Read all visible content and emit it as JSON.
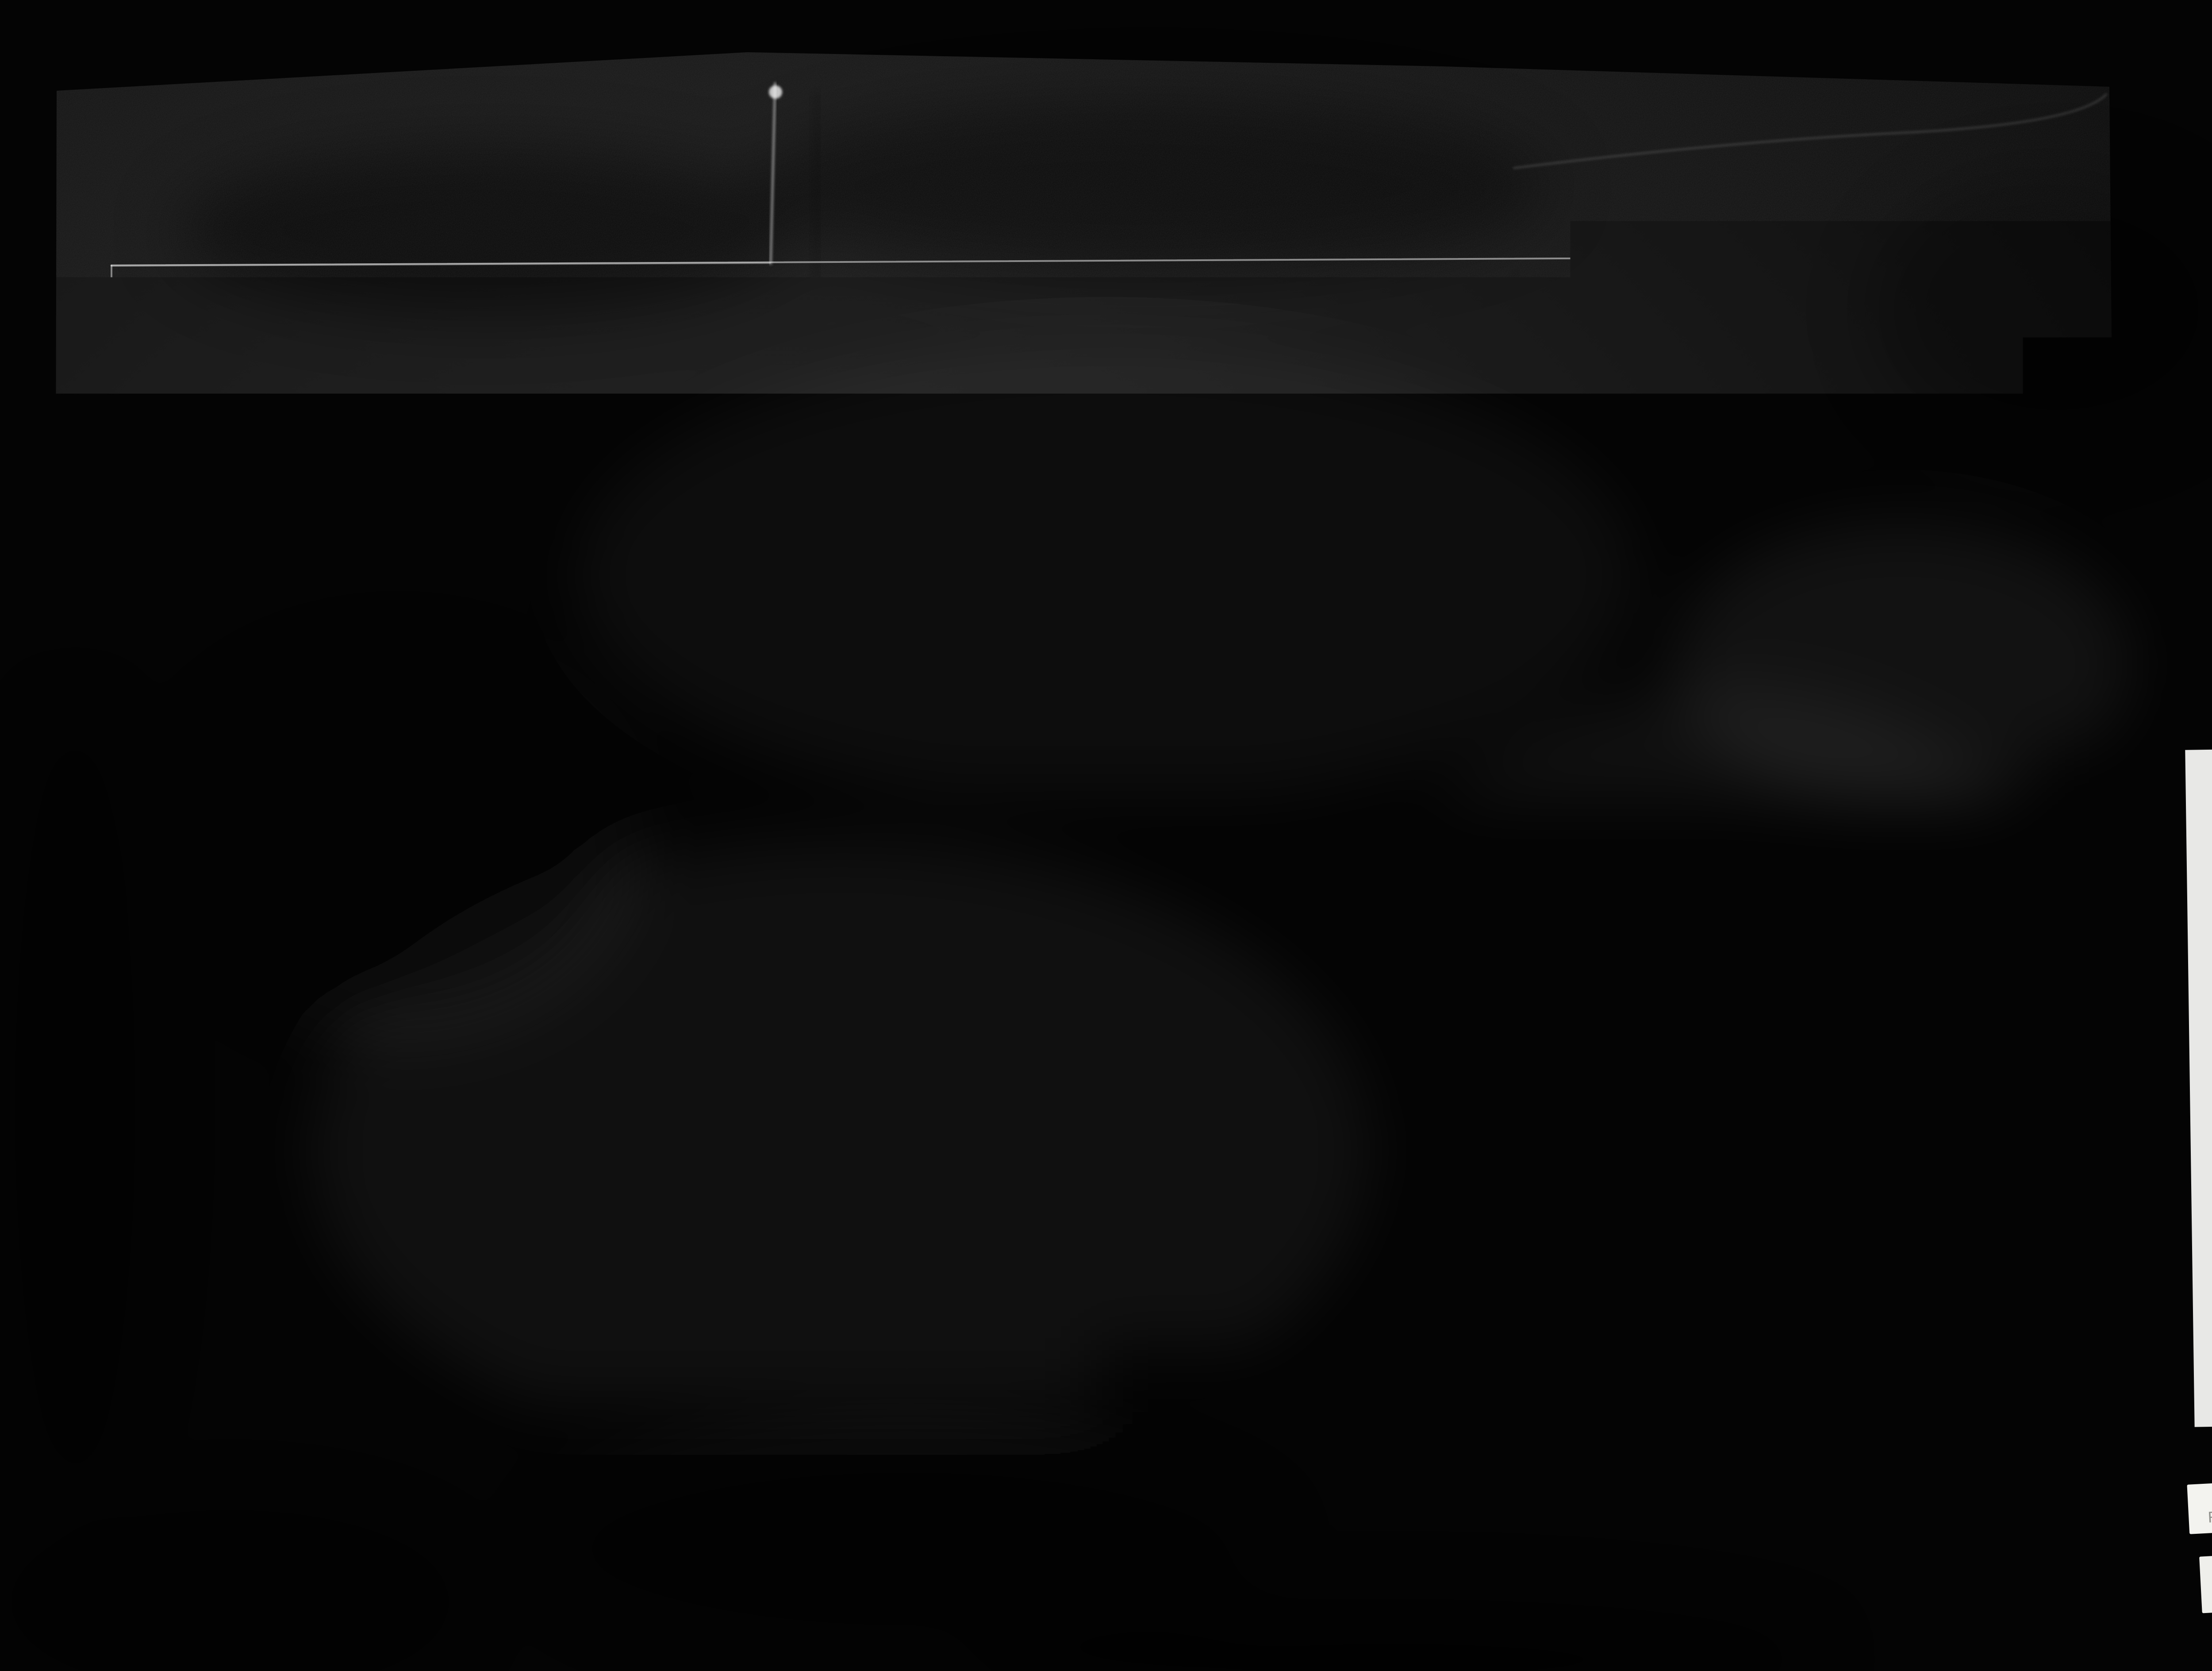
{
  "document": {
    "section": {
      "window_label": "WINDOW",
      "open_verandah_label": "OPEN VERANDAH",
      "dining_room_label": "DINING ROOM.",
      "post_note": "6\"x6\" ROUGH",
      "tents_note": "TENTS",
      "title": "NEW DINING ROOM PARTITION."
    },
    "elevation": {
      "sash_note": "1¾\" SLIDING SASH 9 LIGHTS",
      "paint_note": "D. PRIMED & BACK PUTTIED.",
      "open_verandah_label": "OPEN VERANDAH.",
      "title": "ELEVATION",
      "dim_upper": "5'3\"",
      "dim_full": "8'4\"",
      "dim_lower": "2'7\""
    },
    "plan": {
      "dining_room_label": "DINING ROOM.",
      "kitchen_label": "KITCHEN",
      "doors_note": "NEW DOORS & STEPS",
      "down_label": "DOWN"
    },
    "sketch_plan": {
      "title_line1": "SKETCH PLAN",
      "title_line2": "OF",
      "title_line3": "CAMP.",
      "club_house_label": "CLUB HOUSE.",
      "lav_label": "LAV.",
      "lavatory_note": "NEW LAVATORY",
      "laundry_note": "NEW LAUNDRY HOUSE",
      "heater_note": "NEW HEATER HOUSE",
      "cabins": {
        "cabin_top": {
          "line1": "NEW",
          "line2": "CABIN"
        },
        "cabin_left": {
          "line1": "NEW",
          "line2": "CABIN"
        },
        "cabin_right": {
          "line1": "NEW",
          "line2": "CABIN"
        },
        "no1": "Nº 1",
        "no2": "Nº 2",
        "no3": "Nº 3",
        "no4": "Nº 4",
        "no5": "Nº 5.",
        "no6": "Nº 6.",
        "no7": "Nº 7",
        "no8": "Nº 8",
        "no9": "Nº 9"
      }
    }
  },
  "film": {
    "frame_counter": [
      "8",
      "7",
      "0",
      "0",
      "0"
    ],
    "archive_label_en": "National Archives of Canada",
    "archive_label_fr": "Archives nationales du Canada",
    "repeat_sticker_en": "Repeat",
    "repeat_sticker_fr": "Répétition",
    "faint_sticker_text": "lot de"
  },
  "colors": {
    "film_black": "#030303",
    "paper_dark": "#1a1a1a",
    "line_white": "#e8e8e8",
    "label_paper": "#f1f1ed"
  }
}
